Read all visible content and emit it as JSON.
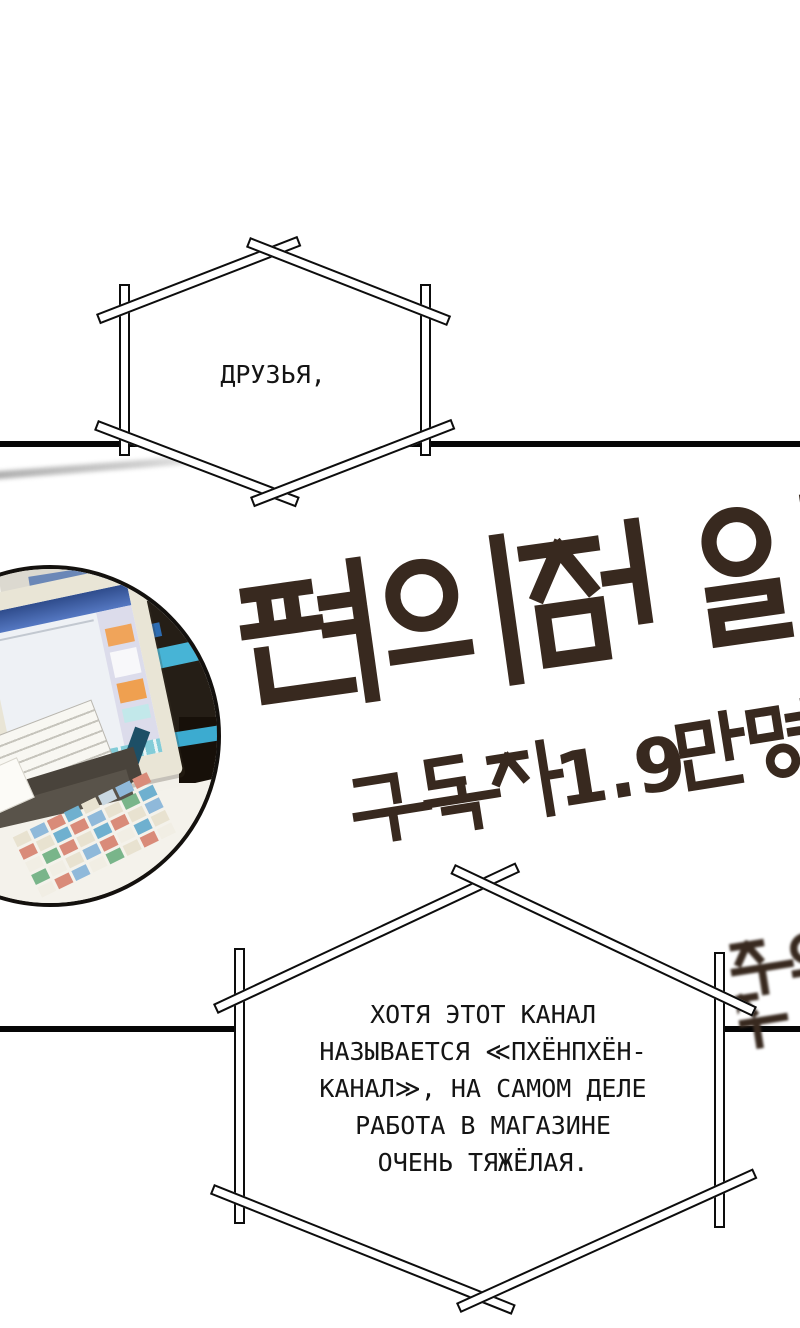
{
  "bubbles": {
    "top": {
      "text": "ДРУЗЬЯ,"
    },
    "bottom": {
      "lines": [
        "ХОТЯ ЭТОТ КАНАЛ",
        "НАЗЫВАЕТСЯ ≪ПХЁНПХЁН-",
        "КАНАЛ≫, НА САМОМ ДЕЛЕ",
        "РАБОТА В МАГАЗИНЕ",
        "ОЧЕНЬ ТЯЖЁЛАЯ."
      ]
    }
  },
  "banner": {
    "title_korean": "편의점 일",
    "subtitle_korean": "구독자 1.9만명",
    "subtitle_digits": "1.9",
    "edge_text_korean": "주의",
    "text_color": "#38291f"
  },
  "photo": {
    "screen_header_color": "#4a6ab5",
    "accent_orange": "#f0a45a",
    "accent_teal": "#47b4d6"
  },
  "colors": {
    "ink": "#0d0d0d",
    "paper": "#ffffff"
  }
}
